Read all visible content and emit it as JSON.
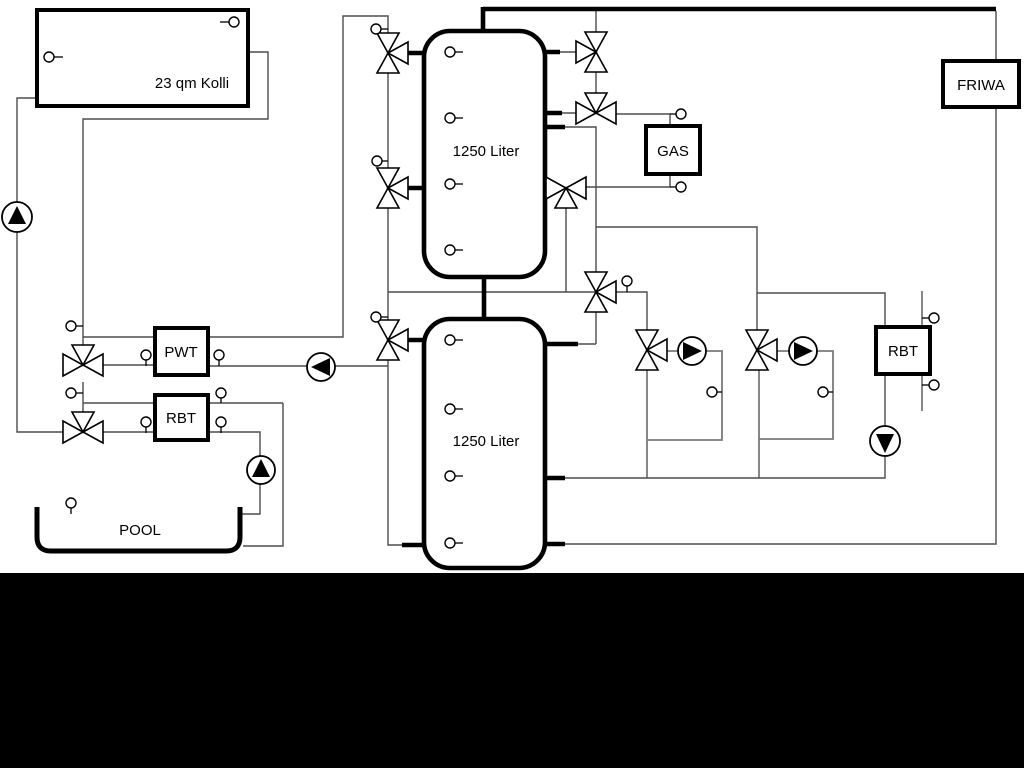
{
  "labels": {
    "collector": "23 qm Kolli",
    "tank_top": "1250 Liter",
    "tank_bottom": "1250 Liter",
    "gas": "GAS",
    "friwa": "FRIWA",
    "pwt": "PWT",
    "rbt_left": "RBT",
    "rbt_right": "RBT",
    "pool": "POOL"
  },
  "colors": {
    "background": "#ffffff",
    "pipe_thin": "#4d4d4d",
    "pipe_loop": "#7a7a7a",
    "component_outline": "#000000",
    "footer_bar": "#000000"
  }
}
